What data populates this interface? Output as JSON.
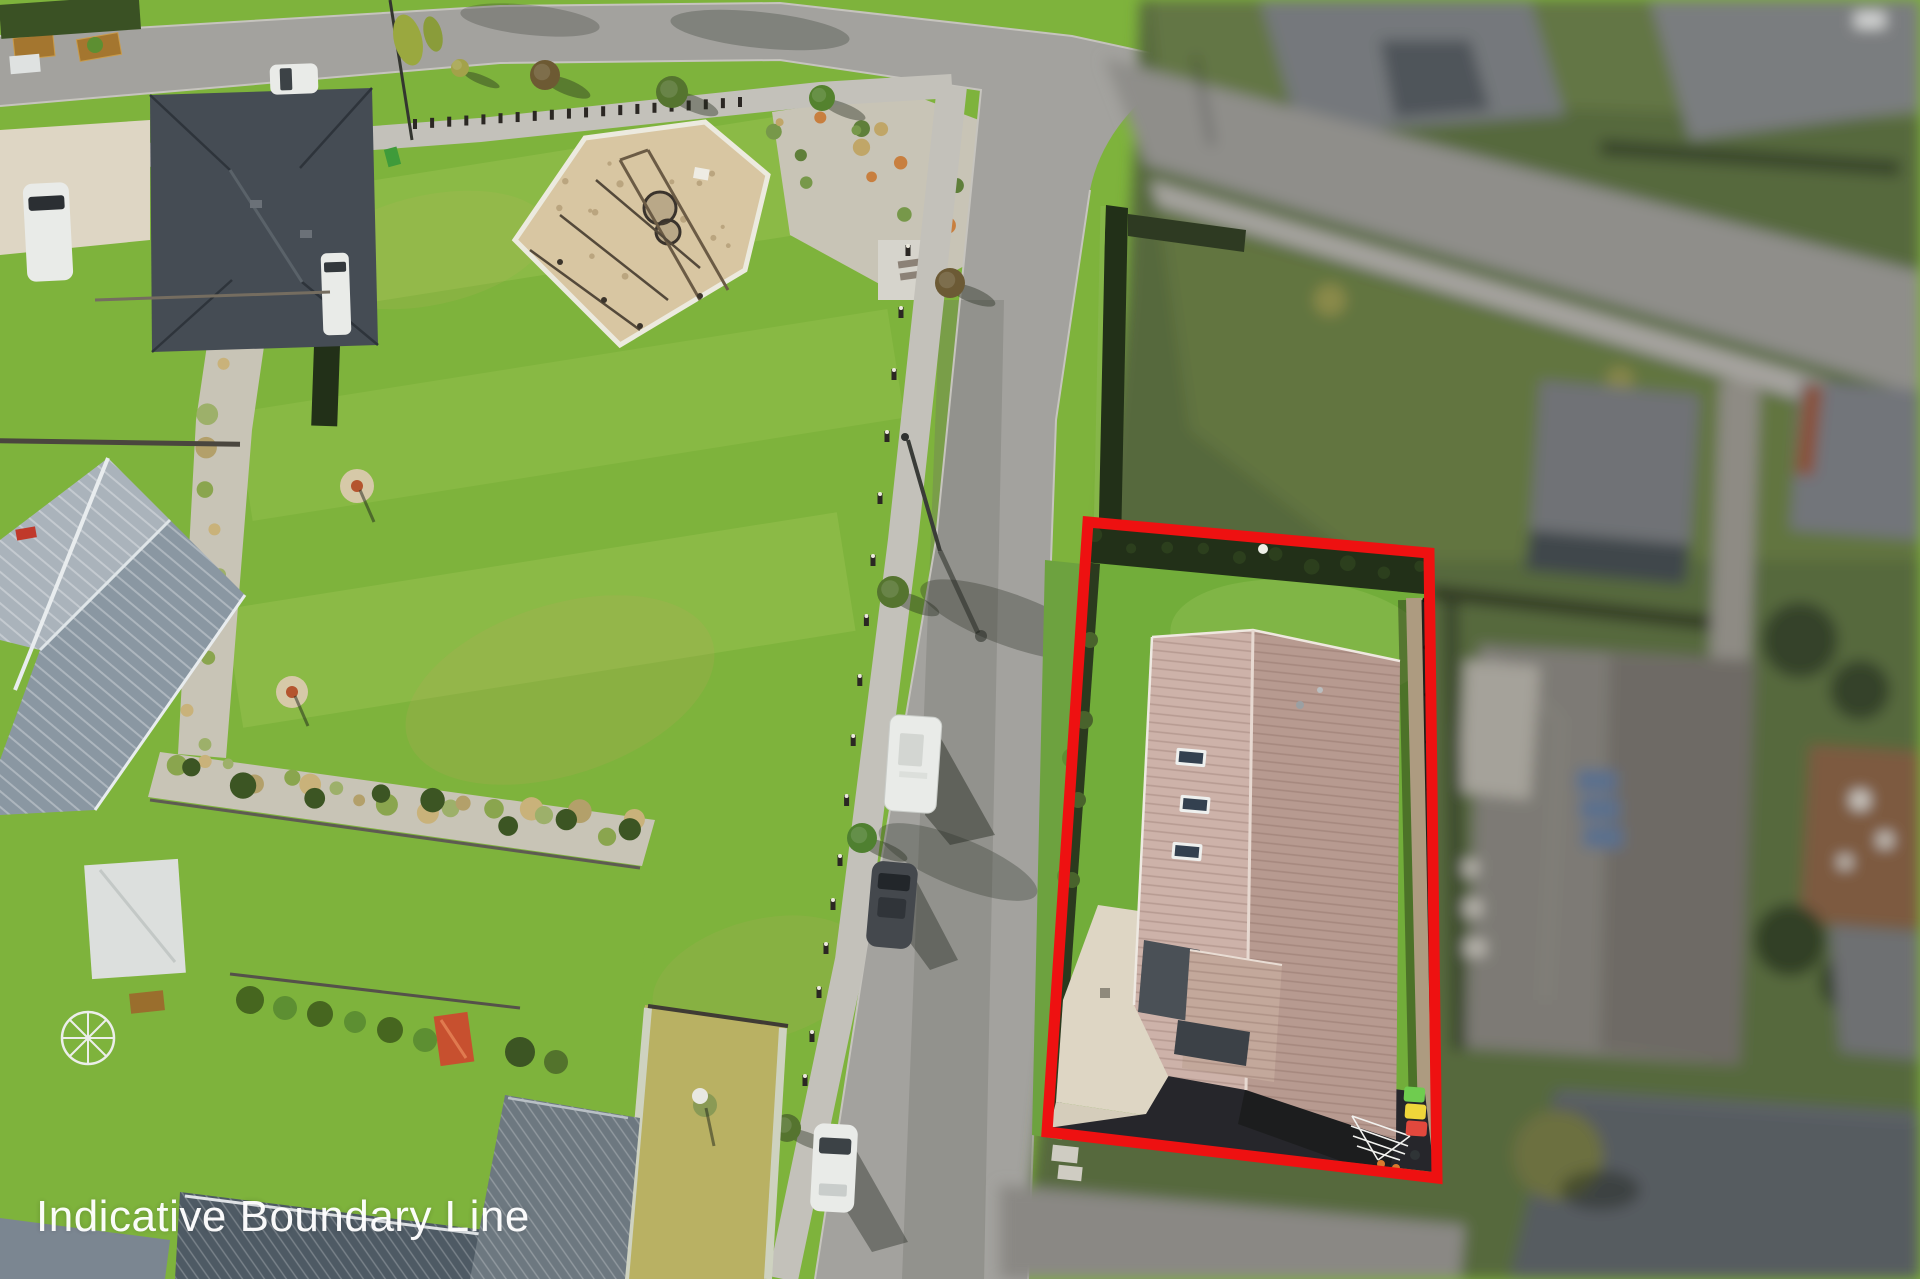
{
  "caption": {
    "text": "Indicative Boundary Line",
    "color": "#ffffff"
  },
  "boundary": {
    "color": "#ee1111",
    "style": "solid-outline"
  },
  "bins": [
    {
      "name": "green",
      "color": "#6fcc4f"
    },
    {
      "name": "yellow",
      "color": "#f0d63a"
    },
    {
      "name": "red",
      "color": "#e2483d"
    }
  ],
  "subject_property": {
    "skylights_count": 3
  },
  "vehicles": [
    "caravan",
    "dark-car",
    "white-car",
    "white-van",
    "driveway-van",
    "road-car"
  ],
  "palette": {
    "park_grass": "#7eb33c",
    "lot_lawn": "#72ad3a",
    "road": "#a3a29e",
    "footpath": "#c3c1ba",
    "playground_mulch": "#d8c6a2",
    "gravel": "#c8c4b6",
    "dark_roof": "#454c54",
    "bluegray_roof": "#8a97a2",
    "subject_roof_light": "#cdb2a9",
    "subject_roof_dark": "#b79a90",
    "hedge_dark": "#223018",
    "concrete": "#ded6c4",
    "asphalt_dark": "#26262b",
    "vehicle_white": "#e9ebe8",
    "blur_lawn": "#57693c",
    "blur_roof": "#75787b",
    "blur_road": "#8f8e8a"
  }
}
